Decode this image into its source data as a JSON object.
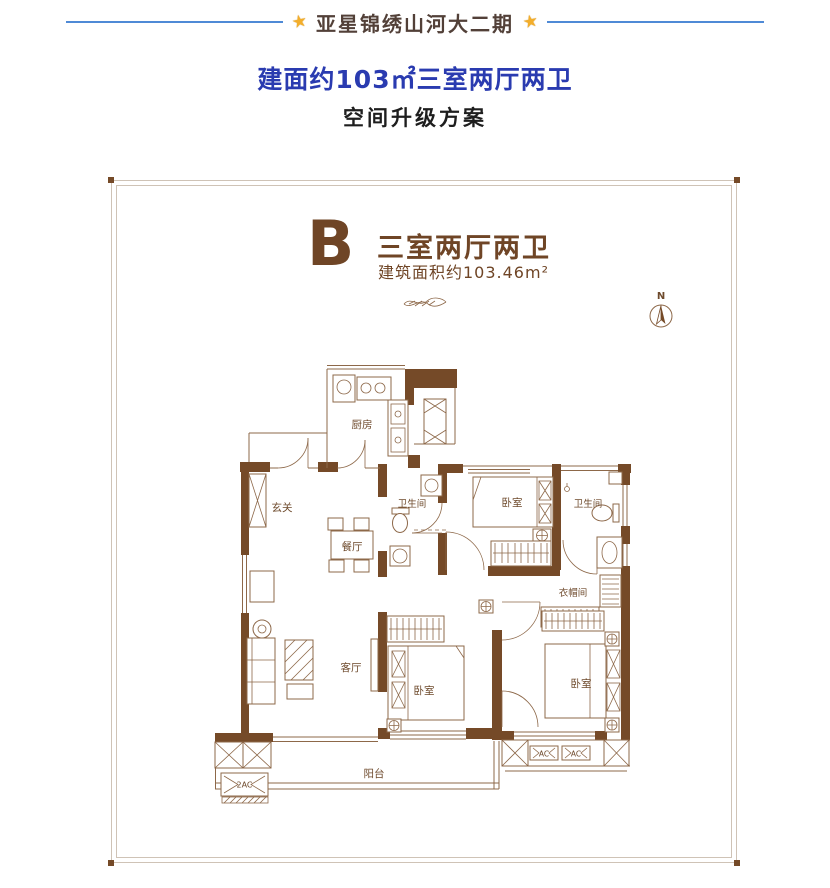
{
  "header": {
    "project_title": "亚星锦绣山河大二期",
    "star_icon": "★",
    "subtitle": "建面约103㎡三室两厅两卫",
    "subheading": "空间升级方案"
  },
  "unit": {
    "letter": "B",
    "layout_title": "三室两厅两卫",
    "area_text": "建筑面积约103.46m²",
    "compass_label": "N"
  },
  "rooms": {
    "kitchen": "厨房",
    "entry": "玄关",
    "dining": "餐厅",
    "bathroom_center": "卫生间",
    "bedroom_top": "卧室",
    "bathroom_right": "卫生间",
    "cloakroom": "衣帽间",
    "living": "客厅",
    "bedroom_bottom_center": "卧室",
    "bedroom_bottom_right": "卧室",
    "balcony": "阳台",
    "balcony_ac": "2AC",
    "ac_unit_1": "AC",
    "ac_unit_2": "AC"
  },
  "colors": {
    "header_line_blue": "#4f8ad6",
    "subtitle_blue": "#2a3bb0",
    "star_gold": "#f3ae2b",
    "title_brown": "#524038",
    "plan_brown": "#6f4526",
    "wall_brown": "#754a28",
    "thin_line_brown": "#8d6849",
    "frame_line": "#cfc3b6"
  }
}
